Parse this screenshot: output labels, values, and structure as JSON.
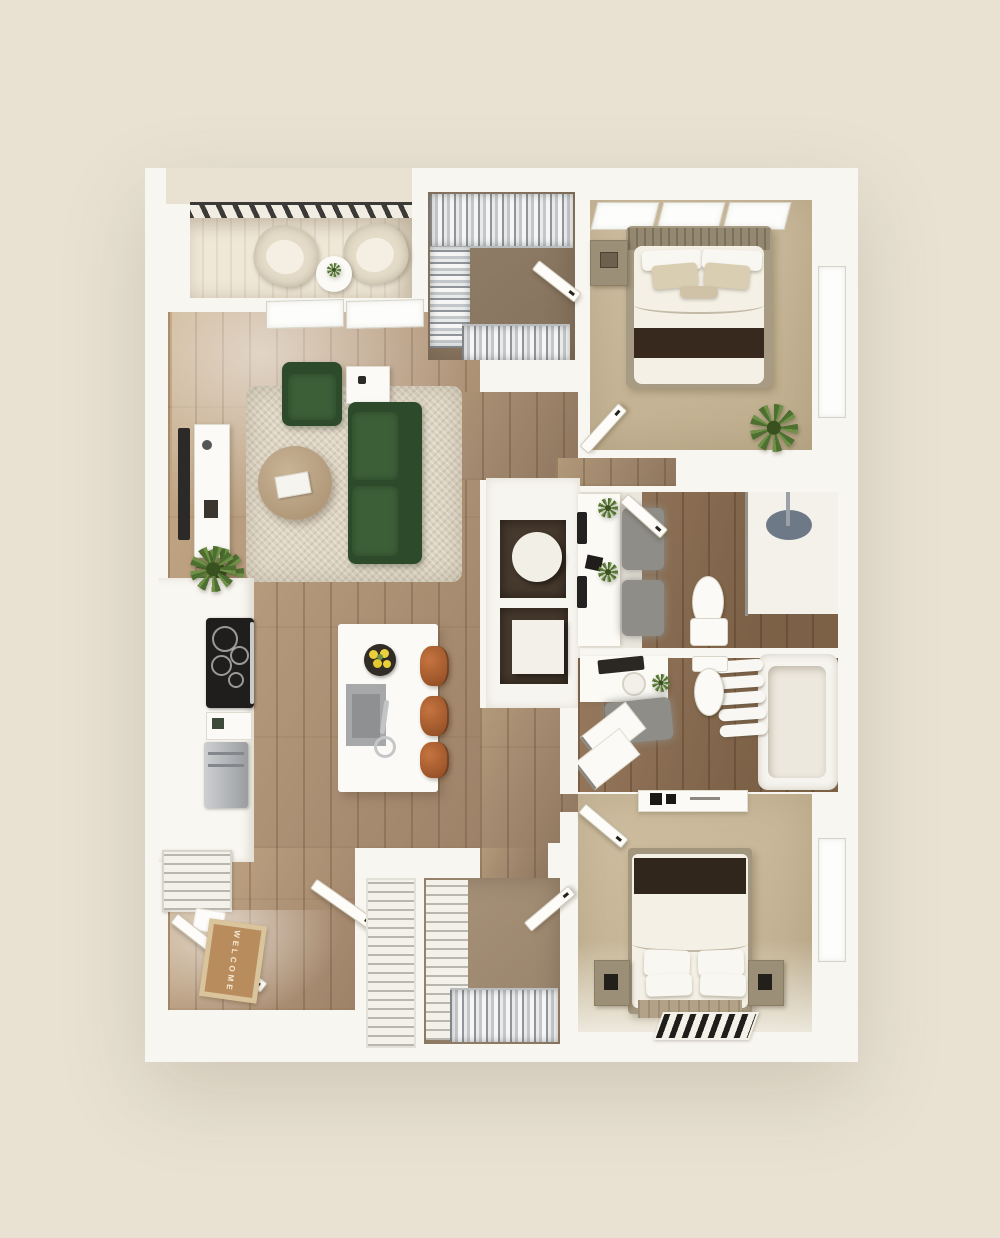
{
  "palette": {
    "background": "#e9e2d3",
    "wall": "#f8f6f1",
    "wood": "#b3977a",
    "tile": "#876c50",
    "carpet-bedroom": "#c8b697",
    "carpet-closet": "#8d7a63",
    "rug-living": "#dcd3c0",
    "sofa-green": "#2d4b2b",
    "stool-leather": "#a55c33",
    "throw-dark": "#37291e",
    "mat-tan": "#b98c5e",
    "railing-dark": "#3b3a37",
    "steel": "#b6b8ba",
    "lemon-yellow": "#e9cf39",
    "plant-green": "#557d35",
    "rug-gray": "#8e8d88",
    "niche-dark": "#46392d"
  },
  "entry": {
    "welcome_mat_text": "WELCOME"
  },
  "rooms": [
    {
      "name": "balcony",
      "items": [
        "railing",
        "outdoor-chair",
        "outdoor-chair",
        "round-side-table"
      ]
    },
    {
      "name": "living-room",
      "items": [
        "sliding-door",
        "tv",
        "tv-console",
        "area-rug",
        "round-coffee-table",
        "books",
        "green-armchair",
        "green-sofa",
        "side-table",
        "floor-plant"
      ]
    },
    {
      "name": "kitchen",
      "items": [
        "counter",
        "cooktop",
        "coffee-maker",
        "refrigerator",
        "wire-cart",
        "counter-plant"
      ]
    },
    {
      "name": "kitchen-island",
      "items": [
        "sink",
        "faucet",
        "lemon-bowl",
        "bar-stool",
        "bar-stool",
        "bar-stool"
      ]
    },
    {
      "name": "walk-in-closet-top",
      "items": [
        "clothes-rack-top",
        "clothes-rack-left",
        "clothes-rack-bottom",
        "door"
      ]
    },
    {
      "name": "bedroom-1",
      "items": [
        "windows",
        "window-right",
        "bed",
        "headboard",
        "pillows",
        "accent-pillows",
        "dark-throw",
        "nightstand",
        "plant",
        "door"
      ]
    },
    {
      "name": "hallway",
      "items": [
        "niche-round-table",
        "niche-cube-cabinet"
      ]
    },
    {
      "name": "bathroom-1",
      "items": [
        "double-vanity",
        "wall-faucets",
        "gray-rugs",
        "plants",
        "toilet",
        "walk-in-shower",
        "shower-mat",
        "glass-panel",
        "door"
      ]
    },
    {
      "name": "bathroom-2",
      "items": [
        "vanity",
        "mirror-tray",
        "sink",
        "plant",
        "toilet",
        "towel-shelf",
        "bathtub",
        "gray-rug",
        "stacked-laundry-units"
      ]
    },
    {
      "name": "entry",
      "items": [
        "front-door",
        "welcome-mat",
        "closet-door"
      ]
    },
    {
      "name": "linen-closet",
      "items": [
        "wire-shelves"
      ]
    },
    {
      "name": "walk-in-closet-bottom",
      "items": [
        "wire-shelves",
        "hanging-clothes",
        "door"
      ]
    },
    {
      "name": "bedroom-2",
      "items": [
        "dresser",
        "decor",
        "door",
        "bed",
        "dark-throw",
        "pillows",
        "foot-bench",
        "nightstand-left",
        "nightstand-right",
        "patterned-rug",
        "window-right"
      ]
    }
  ]
}
